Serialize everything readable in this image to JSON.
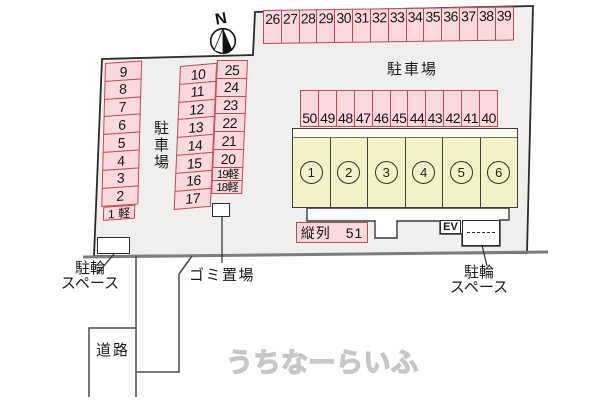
{
  "diagram": {
    "compass_label": "N",
    "watermark": "うちなーらいふ",
    "parking_lot_label_top": "駐車場",
    "parking_lot_label_left": "駐車場",
    "road_label": "道路",
    "garbage_label": "ゴミ置場",
    "bicycle_left": {
      "line1": "駐輪",
      "line2": "スペース"
    },
    "bicycle_right": {
      "line1": "駐輪",
      "line2": "スペース"
    },
    "tandem_label": "縦列　51",
    "elevator_label": "EV"
  },
  "parking": {
    "row_top": [
      "26",
      "27",
      "28",
      "29",
      "30",
      "31",
      "32",
      "33",
      "34",
      "35",
      "36",
      "37",
      "38",
      "39"
    ],
    "row_mid": [
      "50",
      "49",
      "48",
      "47",
      "46",
      "45",
      "44",
      "43",
      "42",
      "41",
      "40"
    ],
    "col_left": [
      "9",
      "8",
      "7",
      "6",
      "5",
      "4",
      "3",
      "2",
      "1 軽"
    ],
    "col_mid": [
      "10",
      "11",
      "12",
      "13",
      "14",
      "15",
      "16",
      "17"
    ],
    "col_right": [
      "25",
      "24",
      "23",
      "22",
      "21",
      "20",
      "19軽",
      "18軽"
    ]
  },
  "building": {
    "units": [
      "1",
      "2",
      "3",
      "4",
      "5",
      "6"
    ]
  },
  "colors": {
    "space_fill": "#f9d9de",
    "space_border": "#c04a52",
    "site_fill": "#f0efed",
    "site_border": "#2b2b2b",
    "building_fill": "#f6f2c8",
    "bottom_boundary": "#7d7d7d"
  }
}
